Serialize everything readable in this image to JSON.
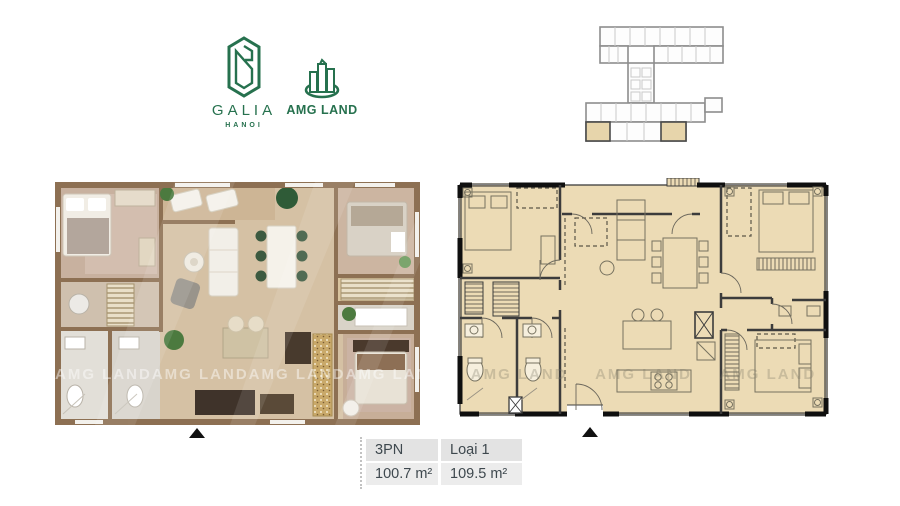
{
  "branding": {
    "galia": {
      "name": "GALIA",
      "subtitle": "HANOI"
    },
    "amg_land": {
      "name": "AMG LAND"
    }
  },
  "watermark": {
    "text": "AMG LAND"
  },
  "keyplan": {
    "highlighted_units": 2,
    "highlight_color": "#e7d5ab",
    "outline_color": "#8d8d8d"
  },
  "colors": {
    "brand_green": "#26714e",
    "technical_plan_beige": "#ecdbb5",
    "render_wall_brown": "#8d7053",
    "wall_black": "#0f0f0f",
    "table_header_bg": "#e3e3e3",
    "table_value_bg": "#ececec",
    "table_text": "#3e484e"
  },
  "spec_table": {
    "columns": [
      {
        "header": "3PN",
        "value": "100.7 m²"
      },
      {
        "header": "Loại 1",
        "value": "109.5 m²"
      }
    ]
  }
}
